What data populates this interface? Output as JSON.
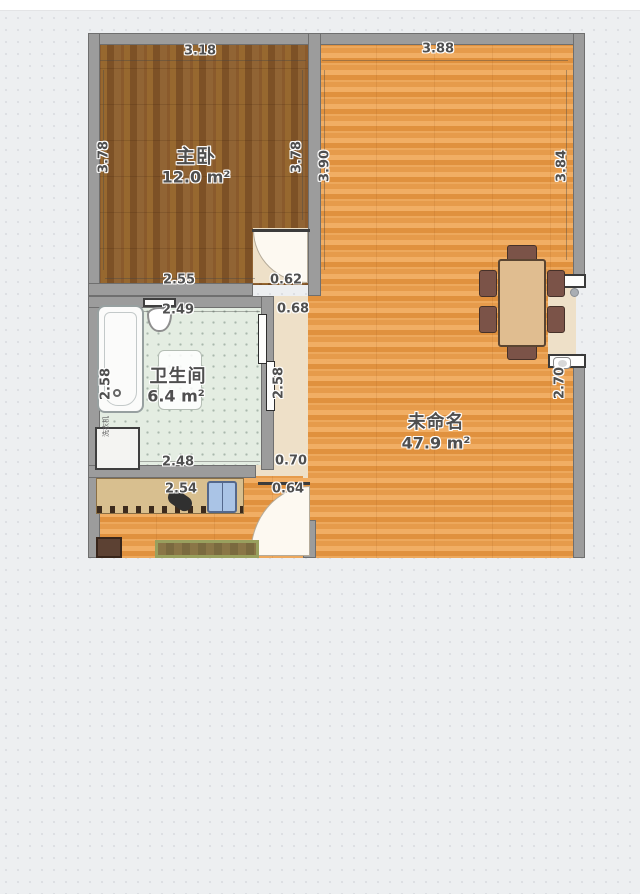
{
  "app": {
    "type": "floor-plan"
  },
  "rooms": {
    "master": {
      "name": "主卧",
      "area": "12.0",
      "unit": "m²"
    },
    "bath": {
      "name": "卫生间",
      "area": "6.4",
      "unit": "m²"
    },
    "living": {
      "name": "未命名",
      "area": "47.9",
      "unit": "m²"
    }
  },
  "dims": [
    {
      "label": "3.18"
    },
    {
      "label": "3.88"
    },
    {
      "label": "3.78"
    },
    {
      "label": "3.78"
    },
    {
      "label": "3.90"
    },
    {
      "label": "3.84"
    },
    {
      "label": "2.55"
    },
    {
      "label": "0.62"
    },
    {
      "label": "2.49"
    },
    {
      "label": "0.68"
    },
    {
      "label": "2.58"
    },
    {
      "label": "2.58"
    },
    {
      "label": "2.70"
    },
    {
      "label": "2.48"
    },
    {
      "label": "0.70"
    },
    {
      "label": "2.54"
    },
    {
      "label": "0.64"
    }
  ],
  "furniture": {
    "washer_label": "洗衣机"
  },
  "colors": {
    "background": "#edeff1",
    "wall": "#9c9c9c",
    "bedroom_floor": "#8f6130",
    "living_floor": "#e8a255",
    "bath_tile": "#e4ede2",
    "corridor_floor": "#eee0c8",
    "table": "#e0bd90",
    "chair": "#7b5348",
    "shirt": "#aac4e6"
  }
}
